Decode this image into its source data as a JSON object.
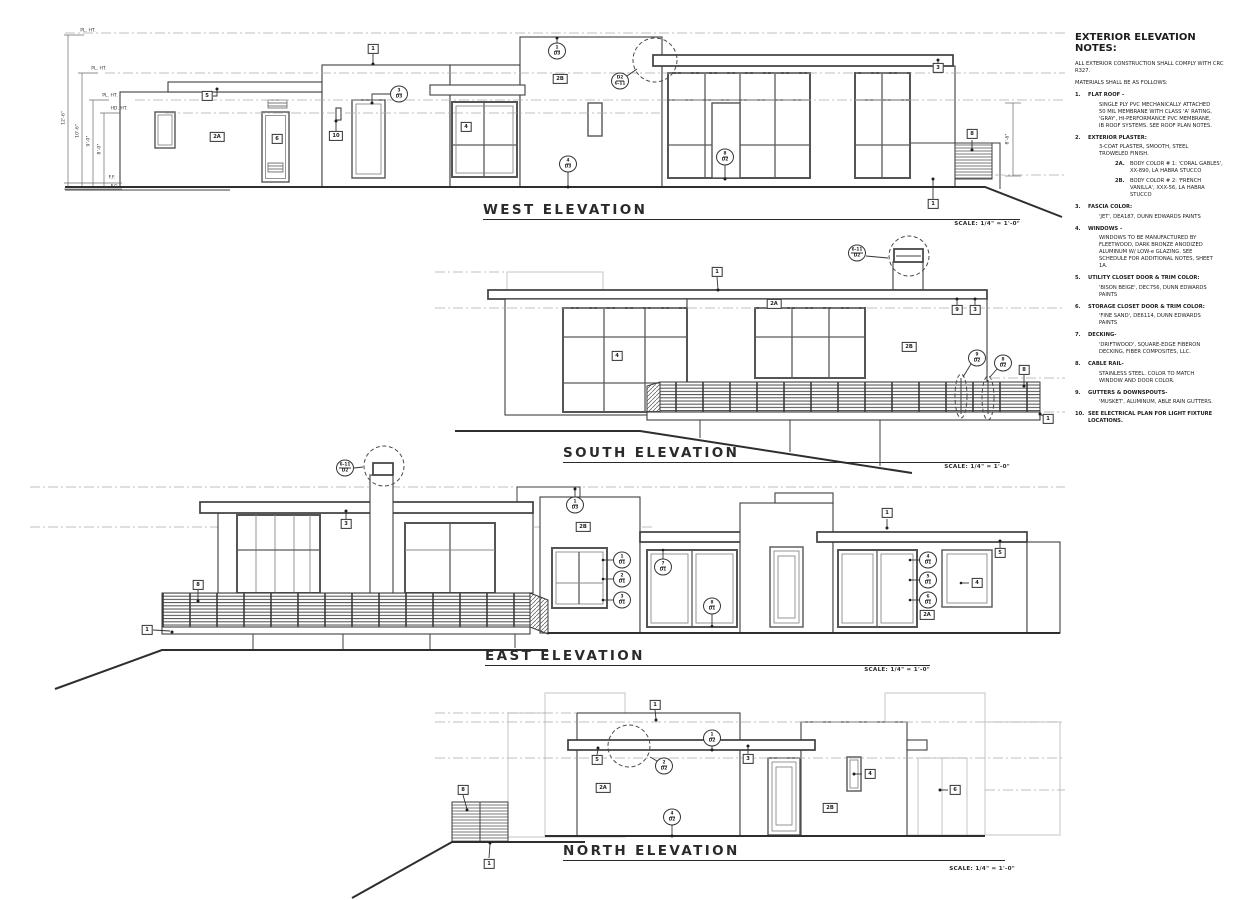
{
  "sheet": {
    "background": "#ffffff",
    "line_color": "#3f3f3f",
    "light_line_color": "#c5c5c5",
    "dash_color": "#ababab"
  },
  "notes": {
    "heading": "EXTERIOR ELEVATION NOTES:",
    "intro": [
      "ALL EXTERIOR CONSTRUCTION SHALL COMPLY WITH CRC R327.",
      "MATERIALS SHALL BE AS FOLLOWS:"
    ],
    "items": [
      {
        "num": "1.",
        "title": "FLAT ROOF -",
        "body": [
          "SINGLE PLY PVC MECHANICALLY ATTACHED 50 MIL MEMBRANE WITH CLASS 'A' RATING, 'GRAY', HI-PERFORMANCE PVC MEMBRANE, IB ROOF SYSTEMS.  SEE ROOF PLAN NOTES."
        ],
        "subitems": []
      },
      {
        "num": "2.",
        "title": "EXTERIOR PLASTER:",
        "body": [
          "3-COAT PLASTER, SMOOTH, STEEL TROWELED FINISH."
        ],
        "subitems": [
          {
            "num": "2A.",
            "text": "BODY COLOR # 1: 'CORAL GABLES', XX-890, LA HABRA STUCCO"
          },
          {
            "num": "2B.",
            "text": "BODY COLOR # 2: 'FRENCH VANILLA', XXX-56, LA HABRA STUCCO"
          }
        ]
      },
      {
        "num": "3.",
        "title": "FASCIA COLOR:",
        "body": [
          "'JET', DEA187, DUNN EDWARDS PAINTS"
        ],
        "subitems": []
      },
      {
        "num": "4.",
        "title": "WINDOWS -",
        "body": [
          "WINDOWS TO BE MANUFACTURED BY FLEETWOOD, DARK BRONZE ANODIZED ALUMINUM W/ LOW-e GLAZING.  SEE SCHEDULE FOR ADDITIONAL NOTES, SHEET 1A."
        ],
        "subitems": []
      },
      {
        "num": "5.",
        "title": "UTILITY CLOSET DOOR & TRIM COLOR:",
        "body": [
          "'BISON BEIGE', DEC756, DUNN EDWARDS PAINTS"
        ],
        "subitems": []
      },
      {
        "num": "6.",
        "title": "STORAGE CLOSET DOOR & TRIM COLOR:",
        "body": [
          "'FINE SAND', DE6114, DUNN EDWARDS PAINTS"
        ],
        "subitems": []
      },
      {
        "num": "7.",
        "title": "DECKING-",
        "body": [
          "'DRIFTWOOD', SQUARE-EDGE FIBERON DECKING, FIBER COMPOSITES, LLC."
        ],
        "subitems": []
      },
      {
        "num": "8.",
        "title": "CABLE RAIL-",
        "body": [
          "STAINLESS STEEL.  COLOR TO MATCH WINDOW AND DOOR COLOR."
        ],
        "subitems": []
      },
      {
        "num": "9.",
        "title": "GUTTERS & DOWNSPOUTS-",
        "body": [
          "'MUSKET', ALUMINUM, ABLE RAIN GUTTERS."
        ],
        "subitems": []
      },
      {
        "num": "10.",
        "title": "SEE ELECTRICAL PLAN FOR LIGHT FIXTURE LOCATIONS.",
        "body": [],
        "subitems": []
      }
    ]
  },
  "elevations": [
    {
      "id": "west",
      "title": "WEST ELEVATION",
      "scale_label": "SCALE: 1/4\" = 1'-0\"",
      "tags": [
        {
          "kind": "box",
          "label": "5",
          "x": 207,
          "y": 96
        },
        {
          "kind": "box",
          "label": "2A",
          "x": 217,
          "y": 137
        },
        {
          "kind": "box",
          "label": "6",
          "x": 277,
          "y": 139
        },
        {
          "kind": "box",
          "label": "10",
          "x": 336,
          "y": 136
        },
        {
          "kind": "box",
          "label": "1",
          "x": 373,
          "y": 49
        },
        {
          "kind": "box",
          "label": "4",
          "x": 466,
          "y": 127
        },
        {
          "kind": "box",
          "label": "2B",
          "x": 560,
          "y": 79
        },
        {
          "kind": "box",
          "label": "3",
          "x": 938,
          "y": 68
        },
        {
          "kind": "box",
          "label": "8",
          "x": 972,
          "y": 134
        },
        {
          "kind": "box",
          "label": "1",
          "x": 933,
          "y": 204
        },
        {
          "kind": "circle",
          "top": "3",
          "bottom": "D3",
          "x": 399,
          "y": 94
        },
        {
          "kind": "circle",
          "top": "1",
          "bottom": "D3",
          "x": 557,
          "y": 51
        },
        {
          "kind": "circle",
          "top": "D2",
          "bottom": "6-11",
          "x": 620,
          "y": 81
        },
        {
          "kind": "circle",
          "top": "4",
          "bottom": "D3",
          "x": 568,
          "y": 164
        },
        {
          "kind": "circle",
          "top": "8",
          "bottom": "D2",
          "x": 725,
          "y": 157
        }
      ],
      "dims": [
        {
          "label": "PL. HT.",
          "x": 88,
          "y": 31,
          "rot": 0
        },
        {
          "label": "PL. HT.",
          "x": 99,
          "y": 69,
          "rot": 0
        },
        {
          "label": "PL. HT.",
          "x": 110,
          "y": 96,
          "rot": 0
        },
        {
          "label": "HD. HT.",
          "x": 119,
          "y": 109,
          "rot": 0
        },
        {
          "label": "F.F.",
          "x": 112,
          "y": 178,
          "rot": 0
        },
        {
          "label": "F.G.",
          "x": 115,
          "y": 187,
          "rot": 0
        },
        {
          "label": "12'-6\"",
          "x": 64,
          "y": 118,
          "rot": -90
        },
        {
          "label": "10'-6\"",
          "x": 78,
          "y": 131,
          "rot": -90
        },
        {
          "label": "9'-0\"",
          "x": 89,
          "y": 141,
          "rot": -90
        },
        {
          "label": "8'-0\"",
          "x": 100,
          "y": 149,
          "rot": -90
        },
        {
          "label": "8'-6\"",
          "x": 1008,
          "y": 139,
          "rot": -90
        }
      ]
    },
    {
      "id": "south",
      "title": "SOUTH ELEVATION",
      "scale_label": "SCALE: 1/4\" = 1'-0\"",
      "tags": [
        {
          "kind": "box",
          "label": "1",
          "x": 717,
          "y": 272
        },
        {
          "kind": "box",
          "label": "2A",
          "x": 774,
          "y": 304
        },
        {
          "kind": "box",
          "label": "4",
          "x": 617,
          "y": 356
        },
        {
          "kind": "box",
          "label": "2B",
          "x": 909,
          "y": 347
        },
        {
          "kind": "box",
          "label": "9",
          "x": 957,
          "y": 310
        },
        {
          "kind": "box",
          "label": "3",
          "x": 975,
          "y": 310
        },
        {
          "kind": "box",
          "label": "8",
          "x": 1024,
          "y": 370
        },
        {
          "kind": "box",
          "label": "1",
          "x": 1048,
          "y": 419
        },
        {
          "kind": "circle",
          "top": "6-11",
          "bottom": "D2",
          "x": 857,
          "y": 253
        },
        {
          "kind": "circle",
          "top": "9",
          "bottom": "D2",
          "x": 977,
          "y": 358
        },
        {
          "kind": "circle",
          "top": "8",
          "bottom": "D2",
          "x": 1003,
          "y": 363
        }
      ],
      "dims": []
    },
    {
      "id": "east",
      "title": "EAST ELEVATION",
      "scale_label": "SCALE: 1/4\" = 1'-0\"",
      "tags": [
        {
          "kind": "box",
          "label": "1",
          "x": 147,
          "y": 630
        },
        {
          "kind": "box",
          "label": "8",
          "x": 198,
          "y": 585
        },
        {
          "kind": "box",
          "label": "3",
          "x": 346,
          "y": 524
        },
        {
          "kind": "box",
          "label": "2B",
          "x": 583,
          "y": 527
        },
        {
          "kind": "box",
          "label": "1",
          "x": 887,
          "y": 513
        },
        {
          "kind": "box",
          "label": "2A",
          "x": 927,
          "y": 615
        },
        {
          "kind": "box",
          "label": "4",
          "x": 977,
          "y": 583
        },
        {
          "kind": "box",
          "label": "5",
          "x": 1000,
          "y": 553
        },
        {
          "kind": "circle",
          "top": "6-11",
          "bottom": "D2",
          "x": 345,
          "y": 468
        },
        {
          "kind": "circle",
          "top": "1",
          "bottom": "D3",
          "x": 575,
          "y": 505
        },
        {
          "kind": "circle",
          "top": "1",
          "bottom": "D1",
          "x": 622,
          "y": 560
        },
        {
          "kind": "circle",
          "top": "2",
          "bottom": "D1",
          "x": 622,
          "y": 579
        },
        {
          "kind": "circle",
          "top": "3",
          "bottom": "D1",
          "x": 622,
          "y": 600
        },
        {
          "kind": "circle",
          "top": "7",
          "bottom": "D1",
          "x": 663,
          "y": 567
        },
        {
          "kind": "circle",
          "top": "8",
          "bottom": "D1",
          "x": 712,
          "y": 606
        },
        {
          "kind": "circle",
          "top": "4",
          "bottom": "D1",
          "x": 928,
          "y": 560
        },
        {
          "kind": "circle",
          "top": "5",
          "bottom": "D1",
          "x": 928,
          "y": 580
        },
        {
          "kind": "circle",
          "top": "6",
          "bottom": "D1",
          "x": 928,
          "y": 600
        }
      ],
      "dims": []
    },
    {
      "id": "north",
      "title": "NORTH ELEVATION",
      "scale_label": "SCALE: 1/4\" = 1'-0\"",
      "tags": [
        {
          "kind": "box",
          "label": "8",
          "x": 463,
          "y": 790
        },
        {
          "kind": "box",
          "label": "1",
          "x": 489,
          "y": 864
        },
        {
          "kind": "box",
          "label": "5",
          "x": 597,
          "y": 760
        },
        {
          "kind": "box",
          "label": "1",
          "x": 655,
          "y": 705
        },
        {
          "kind": "box",
          "label": "2A",
          "x": 603,
          "y": 788
        },
        {
          "kind": "box",
          "label": "3",
          "x": 748,
          "y": 759
        },
        {
          "kind": "box",
          "label": "4",
          "x": 870,
          "y": 774
        },
        {
          "kind": "box",
          "label": "2B",
          "x": 830,
          "y": 808
        },
        {
          "kind": "box",
          "label": "6",
          "x": 955,
          "y": 790
        },
        {
          "kind": "circle",
          "top": "1",
          "bottom": "D2",
          "x": 712,
          "y": 738
        },
        {
          "kind": "circle",
          "top": "2",
          "bottom": "D2",
          "x": 664,
          "y": 766
        },
        {
          "kind": "circle",
          "top": "4",
          "bottom": "D2",
          "x": 672,
          "y": 817
        }
      ],
      "dims": []
    }
  ]
}
